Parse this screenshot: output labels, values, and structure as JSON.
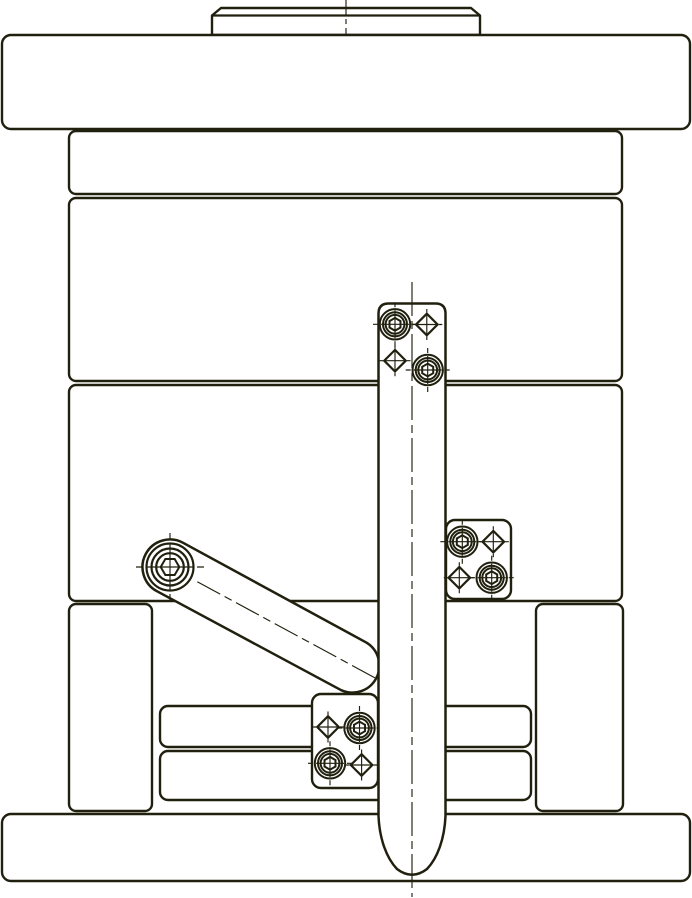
{
  "drawing": {
    "description": "Engineering line drawing: side view of a mold die-set assembly with latch-lock mechanism",
    "paper_color": "#ffffff",
    "ink_color": "#21200f"
  },
  "components": [
    "locating-ring",
    "top-clamping-plate",
    "upper-mold-plate",
    "cavity-plate",
    "core-plate",
    "left-spacer-block",
    "right-spacer-block",
    "ejector-retainer-plate",
    "ejector-base-plate",
    "bottom-clamping-plate",
    "latch-lock-arm",
    "pivot-shoulder-screw",
    "side-latch-block",
    "lower-latch-block",
    "latch-bar",
    "socket-head-screw-mark",
    "dowel-pin-mark",
    "center-line"
  ]
}
